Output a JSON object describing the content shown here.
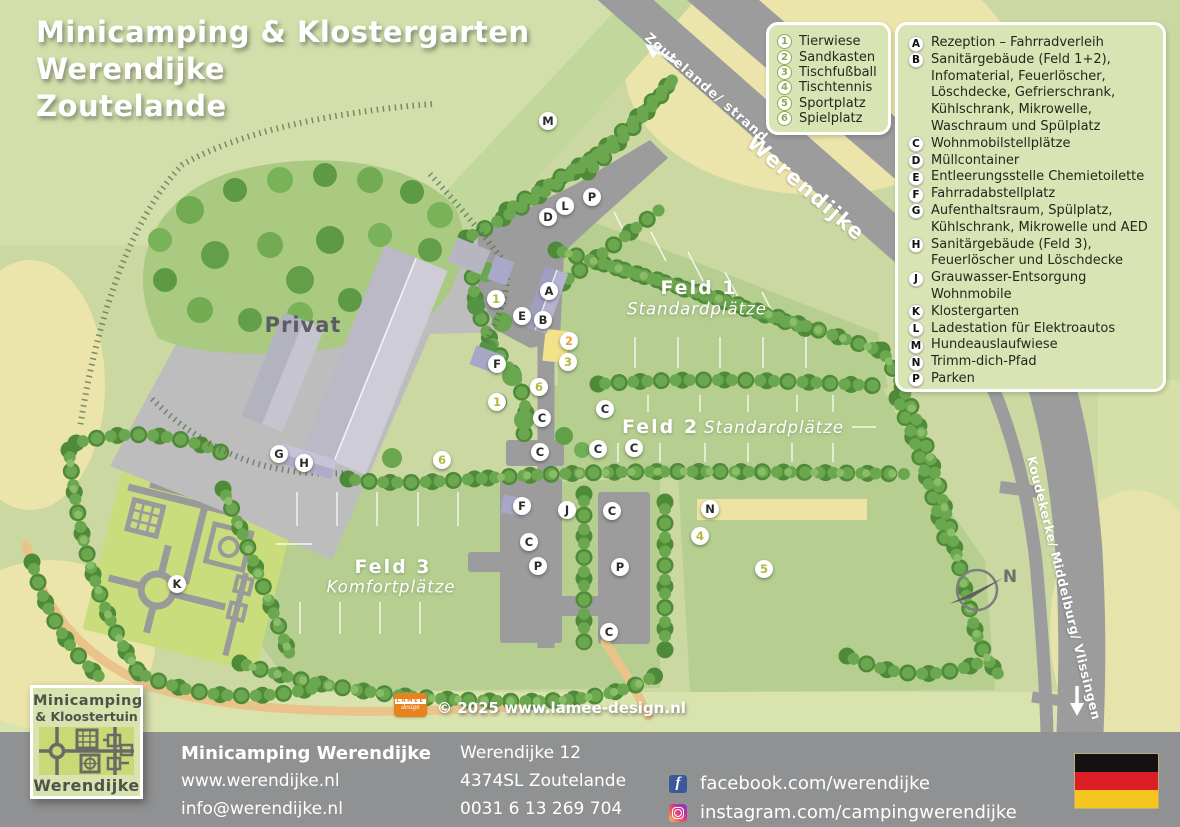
{
  "title": {
    "line1": "Minicamping & Klostergarten",
    "line2": "Werendijke",
    "line3": "Zoutelande"
  },
  "legend_numbers": {
    "items": [
      {
        "num": "1",
        "label": "Tierwiese"
      },
      {
        "num": "2",
        "label": "Sandkasten"
      },
      {
        "num": "3",
        "label": "Tischfußball"
      },
      {
        "num": "4",
        "label": "Tischtennis"
      },
      {
        "num": "5",
        "label": "Sportplatz"
      },
      {
        "num": "6",
        "label": "Spielplatz"
      }
    ]
  },
  "legend_letters": {
    "items": [
      {
        "letter": "A",
        "lines": [
          "Rezeption – Fahrradverleih"
        ]
      },
      {
        "letter": "B",
        "lines": [
          "Sanitärgebäude (Feld 1+2),",
          "Infomaterial, Feuerlöscher,",
          "Löschdecke, Gefrierschrank,",
          "Kühlschrank, Mikrowelle,",
          "Waschraum und Spülplatz"
        ]
      },
      {
        "letter": "C",
        "lines": [
          "Wohnmobilstellplätze"
        ]
      },
      {
        "letter": "D",
        "lines": [
          "Müllcontainer"
        ]
      },
      {
        "letter": "E",
        "lines": [
          "Entleerungsstelle Chemietoilette"
        ]
      },
      {
        "letter": "F",
        "lines": [
          "Fahrradabstellplatz"
        ]
      },
      {
        "letter": "G",
        "lines": [
          "Aufenthaltsraum, Spülplatz,",
          "Kühlschrank, Mikrowelle und AED"
        ]
      },
      {
        "letter": "H",
        "lines": [
          "Sanitärgebäude (Feld 3),",
          "Feuerlöscher und Löschdecke"
        ]
      },
      {
        "letter": "J",
        "lines": [
          "Grauwasser-Entsorgung Wohnmobile"
        ]
      },
      {
        "letter": "K",
        "lines": [
          "Klostergarten"
        ]
      },
      {
        "letter": "L",
        "lines": [
          "Ladestation für Elektroautos"
        ]
      },
      {
        "letter": "M",
        "lines": [
          "Hundeauslaufwiese"
        ]
      },
      {
        "letter": "N",
        "lines": [
          "Trimm-dich-Pfad"
        ]
      },
      {
        "letter": "P",
        "lines": [
          "Parken"
        ]
      }
    ]
  },
  "map": {
    "labels": {
      "privat": "Privat",
      "feld1": "Feld 1",
      "feld1_sub": "Standardplätze",
      "feld2": "Feld 2",
      "feld2_sub": "Standardplätze",
      "feld3": "Feld 3",
      "feld3_sub": "Komfortplätze"
    },
    "roads": {
      "top": "Zoutelande/ strand",
      "main": "Werendijke",
      "right": "Koudekerke/ Middelburg/ Vlissingen"
    },
    "compass": "N",
    "letter_markers": [
      {
        "label": "M",
        "x": 548,
        "y": 121
      },
      {
        "label": "P",
        "x": 592,
        "y": 197
      },
      {
        "label": "L",
        "x": 565,
        "y": 206
      },
      {
        "label": "D",
        "x": 548,
        "y": 217
      },
      {
        "label": "A",
        "x": 549,
        "y": 291
      },
      {
        "label": "E",
        "x": 522,
        "y": 316
      },
      {
        "label": "B",
        "x": 543,
        "y": 320
      },
      {
        "label": "F",
        "x": 497,
        "y": 364
      },
      {
        "label": "G",
        "x": 279,
        "y": 454
      },
      {
        "label": "H",
        "x": 304,
        "y": 463
      },
      {
        "label": "C",
        "x": 605,
        "y": 409
      },
      {
        "label": "C",
        "x": 542,
        "y": 418
      },
      {
        "label": "C",
        "x": 540,
        "y": 452
      },
      {
        "label": "C",
        "x": 598,
        "y": 449
      },
      {
        "label": "C",
        "x": 634,
        "y": 448
      },
      {
        "label": "F",
        "x": 522,
        "y": 506
      },
      {
        "label": "J",
        "x": 567,
        "y": 510
      },
      {
        "label": "C",
        "x": 612,
        "y": 511
      },
      {
        "label": "C",
        "x": 529,
        "y": 542
      },
      {
        "label": "P",
        "x": 538,
        "y": 566
      },
      {
        "label": "P",
        "x": 620,
        "y": 567
      },
      {
        "label": "C",
        "x": 609,
        "y": 632
      },
      {
        "label": "K",
        "x": 177,
        "y": 584
      },
      {
        "label": "N",
        "x": 710,
        "y": 509
      }
    ],
    "number_markers": [
      {
        "label": "1",
        "x": 496,
        "y": 299
      },
      {
        "label": "2",
        "x": 569,
        "y": 341
      },
      {
        "label": "3",
        "x": 568,
        "y": 362
      },
      {
        "label": "6",
        "x": 539,
        "y": 387
      },
      {
        "label": "1",
        "x": 497,
        "y": 402
      },
      {
        "label": "6",
        "x": 442,
        "y": 460
      },
      {
        "label": "4",
        "x": 700,
        "y": 536
      },
      {
        "label": "5",
        "x": 764,
        "y": 569
      }
    ]
  },
  "credit": {
    "badge_line1": "LAMEE",
    "badge_line2": "design",
    "text": "© 2025 www.lamee-design.nl"
  },
  "footer": {
    "logo": {
      "line1": "Minicamping",
      "line2": "& Kloostertuin",
      "line3": "Werendijke"
    },
    "name": "Minicamping Werendijke",
    "website": "www.werendijke.nl",
    "email": "info@werendijke.nl",
    "address_line1": "Werendijke 12",
    "address_line2": "4374SL Zoutelande",
    "phone": "0031 6 13 269 704",
    "facebook": "facebook.com/werendijke",
    "instagram": "instagram.com/campingwerendijke"
  },
  "colors": {
    "facebook_blue": "#3b5998",
    "flag_black": "#151110",
    "flag_red": "#dc1f26",
    "flag_gold": "#f6c51f",
    "road_gray": "#9c9c9c",
    "footer_gray": "#909192",
    "hedge_green": "#4f8a39",
    "field_green": "#b6cf91",
    "legend_circle_green": "#8aac52",
    "map_number_olive": "#b2b93e",
    "credit_orange": "#e8821e"
  }
}
